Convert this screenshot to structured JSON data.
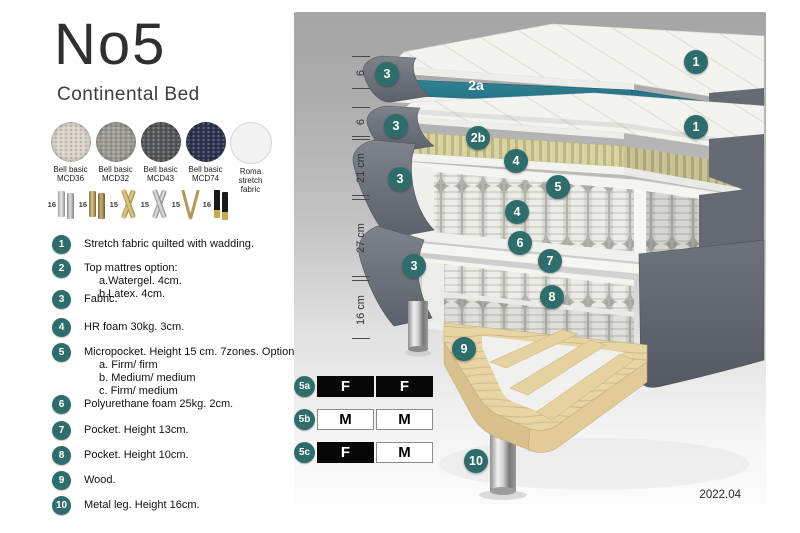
{
  "header": {
    "title": "No5",
    "subtitle": "Continental Bed"
  },
  "colors": {
    "callout": "#2e6d6c",
    "watergel": "#2b7d90",
    "latex": "#d9d3a2",
    "fabric_gray": "#6b707a",
    "wood": "#e8d5a5"
  },
  "swatches": [
    {
      "line1": "Bell basic",
      "line2": "MCD36",
      "color": "#d8d3c8",
      "type": "woven"
    },
    {
      "line1": "Bell basic",
      "line2": "MCD32",
      "color": "#9d9a95",
      "type": "woven"
    },
    {
      "line1": "Bell basic",
      "line2": "MCD43",
      "color": "#55575a",
      "type": "woven"
    },
    {
      "line1": "Bell basic",
      "line2": "MCD74",
      "color": "#2f3550",
      "type": "woven"
    },
    {
      "line1": "Roma",
      "line2": "stretch fabric",
      "color": "#f2f2f2",
      "type": "plain"
    }
  ],
  "legs_options": [
    {
      "size": "16",
      "type": "silver-pair"
    },
    {
      "size": "16",
      "type": "brass-pair"
    },
    {
      "size": "15",
      "type": "gold-cross"
    },
    {
      "size": "15",
      "type": "silver-cross"
    },
    {
      "size": "15",
      "type": "hairpin"
    },
    {
      "size": "16",
      "type": "black-gold"
    }
  ],
  "list": {
    "items": [
      {
        "num": "1",
        "text": "Stretch fabric quilted with wadding.",
        "subs": []
      },
      {
        "num": "2",
        "text": "Top mattres option:",
        "subs": [
          "a.Watergel. 4cm.",
          "b.Latex. 4cm."
        ]
      },
      {
        "num": "3",
        "text": "Fabric.",
        "subs": []
      },
      {
        "num": "4",
        "text": "HR foam 30kg. 3cm.",
        "subs": []
      },
      {
        "num": "5",
        "text": "Micropocket. Height 15 cm. 7zones. Option:",
        "subs": [
          "a. Firm/ firm",
          "b. Medium/ medium",
          "c. Firm/ medium"
        ]
      },
      {
        "num": "6",
        "text": "Polyurethane foam 25kg. 2cm.",
        "subs": []
      },
      {
        "num": "7",
        "text": "Pocket. Height 13cm.",
        "subs": []
      },
      {
        "num": "8",
        "text": "Pocket. Height 10cm.",
        "subs": []
      },
      {
        "num": "9",
        "text": "Wood.",
        "subs": []
      },
      {
        "num": "10",
        "text": "Metal leg. Height 16cm.",
        "subs": []
      }
    ]
  },
  "diagram": {
    "dimensions": [
      {
        "label": "6"
      },
      {
        "label": "6"
      },
      {
        "label": "21 cm"
      },
      {
        "label": "27 cm"
      },
      {
        "label": "16 cm"
      }
    ],
    "callouts": [
      {
        "id": "3-top",
        "label": "3"
      },
      {
        "id": "2a",
        "label": "2a"
      },
      {
        "id": "1-top",
        "label": "1"
      },
      {
        "id": "3-second",
        "label": "3"
      },
      {
        "id": "2b",
        "label": "2b"
      },
      {
        "id": "1-second",
        "label": "1"
      },
      {
        "id": "4-upper",
        "label": "4"
      },
      {
        "id": "5",
        "label": "5"
      },
      {
        "id": "3-third",
        "label": "3"
      },
      {
        "id": "4-lower",
        "label": "4"
      },
      {
        "id": "6",
        "label": "6"
      },
      {
        "id": "7",
        "label": "7"
      },
      {
        "id": "3-fourth",
        "label": "3"
      },
      {
        "id": "8",
        "label": "8"
      },
      {
        "id": "9",
        "label": "9"
      },
      {
        "id": "10",
        "label": "10"
      }
    ],
    "firmness_table": {
      "rows": [
        {
          "badge": "5a",
          "cells": [
            {
              "text": "F",
              "variant": "dark"
            },
            {
              "text": "F",
              "variant": "dark"
            }
          ]
        },
        {
          "badge": "5b",
          "cells": [
            {
              "text": "M",
              "variant": "light"
            },
            {
              "text": "M",
              "variant": "light"
            }
          ]
        },
        {
          "badge": "5c",
          "cells": [
            {
              "text": "F",
              "variant": "dark"
            },
            {
              "text": "M",
              "variant": "light"
            }
          ]
        }
      ]
    },
    "version": "2022.04"
  }
}
